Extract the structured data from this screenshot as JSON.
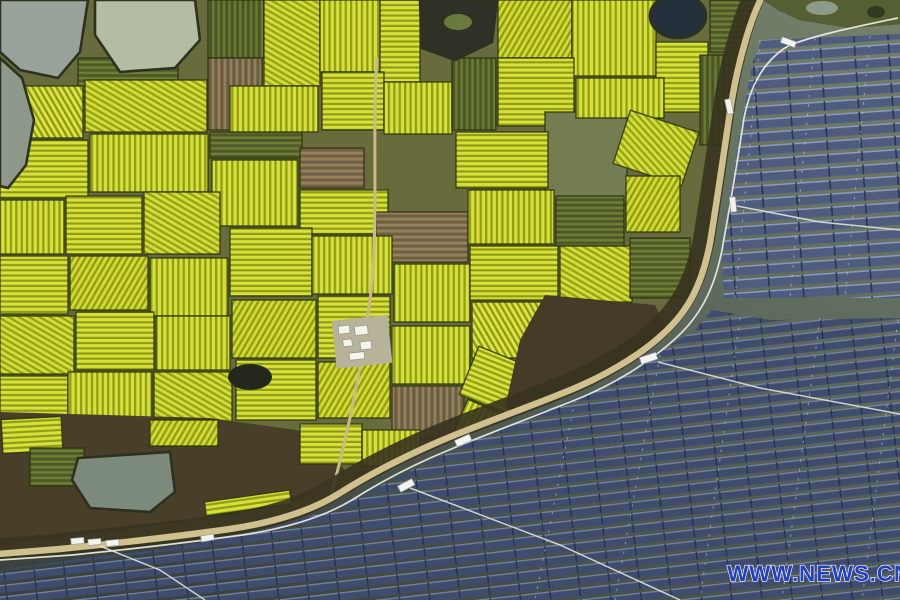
{
  "photo": {
    "kind": "aerial-photograph",
    "scene": {
      "land": "patchwork of yellow rapeseed fields with ponds and farm roads",
      "water": "floating solar panel arrays on a reservoir",
      "divider": "curved shoreline embankment road"
    },
    "watermark": {
      "text": "WWW.NEWS.CN",
      "color": "#2141c2",
      "outline_color": "#ffffff"
    },
    "palette": {
      "rapeseed_yellow": "#d8e139",
      "field_green": "#6f7e37",
      "plowed_brown": "#95825c",
      "pond_water": "#9aa396",
      "lake_water": "#5c685c",
      "lake_water_dark": "#3a433d",
      "solar_panel_blue": "#4f5c80",
      "road_tan": "#cfc08d"
    }
  }
}
